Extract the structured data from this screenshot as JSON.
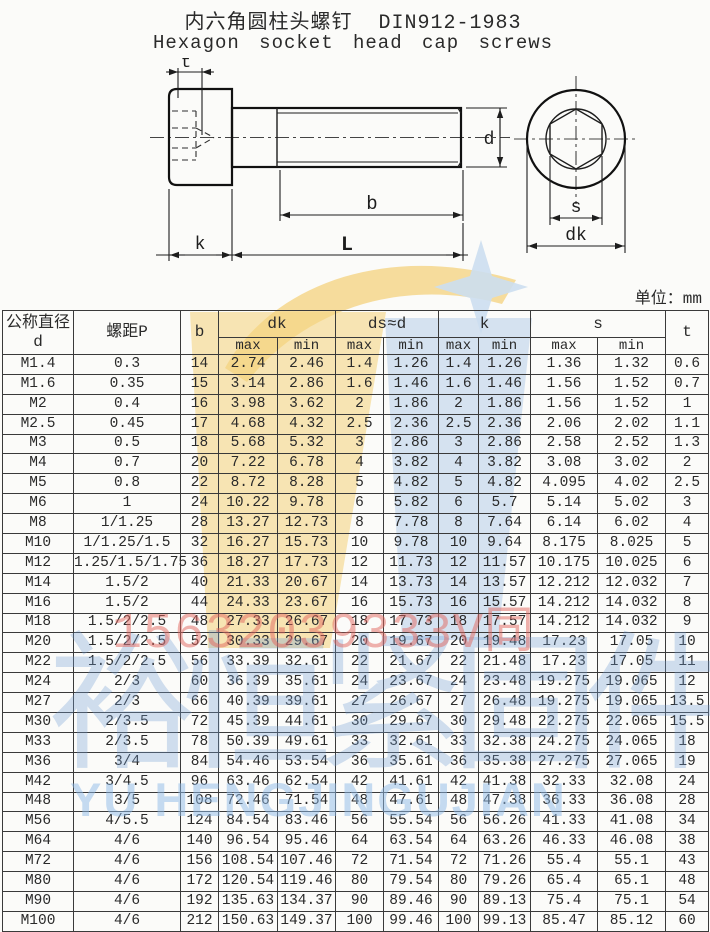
{
  "title": "内六角圆柱头螺钉  DIN912-1983",
  "subtitle": "Hexagon socket head cap screws",
  "unit_note": "单位：mm",
  "diagram": {
    "labels": {
      "t": "t",
      "d": "d",
      "b": "b",
      "k": "k",
      "L": "L",
      "s": "s",
      "dk": "dk"
    }
  },
  "watermark": {
    "phone": "15632039333V同",
    "company_cn": "裕恒紧固件",
    "company_en": "YU HENGJINGUJIAN",
    "yellow": "#f5d584",
    "blue": "#bcd2e9",
    "star_blue": "#ccdeef",
    "red": "#e2655d"
  },
  "table": {
    "headers": {
      "col1_line1": "公称直径",
      "col1_line2": "d",
      "pitch": "螺距P",
      "b": "b",
      "dk": "dk",
      "ds": "ds≈d",
      "k": "k",
      "s": "s",
      "t": "t",
      "max": "max",
      "min": "min"
    },
    "rows": [
      [
        "M1.4",
        "0.3",
        "14",
        "2.74",
        "2.46",
        "1.4",
        "1.26",
        "1.4",
        "1.26",
        "1.36",
        "1.32",
        "0.6"
      ],
      [
        "M1.6",
        "0.35",
        "15",
        "3.14",
        "2.86",
        "1.6",
        "1.46",
        "1.6",
        "1.46",
        "1.56",
        "1.52",
        "0.7"
      ],
      [
        "M2",
        "0.4",
        "16",
        "3.98",
        "3.62",
        "2",
        "1.86",
        "2",
        "1.86",
        "1.56",
        "1.52",
        "1"
      ],
      [
        "M2.5",
        "0.45",
        "17",
        "4.68",
        "4.32",
        "2.5",
        "2.36",
        "2.5",
        "2.36",
        "2.06",
        "2.02",
        "1.1"
      ],
      [
        "M3",
        "0.5",
        "18",
        "5.68",
        "5.32",
        "3",
        "2.86",
        "3",
        "2.86",
        "2.58",
        "2.52",
        "1.3"
      ],
      [
        "M4",
        "0.7",
        "20",
        "7.22",
        "6.78",
        "4",
        "3.82",
        "4",
        "3.82",
        "3.08",
        "3.02",
        "2"
      ],
      [
        "M5",
        "0.8",
        "22",
        "8.72",
        "8.28",
        "5",
        "4.82",
        "5",
        "4.82",
        "4.095",
        "4.02",
        "2.5"
      ],
      [
        "M6",
        "1",
        "24",
        "10.22",
        "9.78",
        "6",
        "5.82",
        "6",
        "5.7",
        "5.14",
        "5.02",
        "3"
      ],
      [
        "M8",
        "1/1.25",
        "28",
        "13.27",
        "12.73",
        "8",
        "7.78",
        "8",
        "7.64",
        "6.14",
        "6.02",
        "4"
      ],
      [
        "M10",
        "1/1.25/1.5",
        "32",
        "16.27",
        "15.73",
        "10",
        "9.78",
        "10",
        "9.64",
        "8.175",
        "8.025",
        "5"
      ],
      [
        "M12",
        "1.25/1.5/1.75",
        "36",
        "18.27",
        "17.73",
        "12",
        "11.73",
        "12",
        "11.57",
        "10.175",
        "10.025",
        "6"
      ],
      [
        "M14",
        "1.5/2",
        "40",
        "21.33",
        "20.67",
        "14",
        "13.73",
        "14",
        "13.57",
        "12.212",
        "12.032",
        "7"
      ],
      [
        "M16",
        "1.5/2",
        "44",
        "24.33",
        "23.67",
        "16",
        "15.73",
        "16",
        "15.57",
        "14.212",
        "14.032",
        "8"
      ],
      [
        "M18",
        "1.5/2/2.5",
        "48",
        "27.33",
        "26.67",
        "18",
        "17.73",
        "18",
        "17.57",
        "14.212",
        "14.032",
        "9"
      ],
      [
        "M20",
        "1.5/2/2.5",
        "52",
        "30.33",
        "29.67",
        "20",
        "19.67",
        "20",
        "19.48",
        "17.23",
        "17.05",
        "10"
      ],
      [
        "M22",
        "1.5/2/2.5",
        "56",
        "33.39",
        "32.61",
        "22",
        "21.67",
        "22",
        "21.48",
        "17.23",
        "17.05",
        "11"
      ],
      [
        "M24",
        "2/3",
        "60",
        "36.39",
        "35.61",
        "24",
        "23.67",
        "24",
        "23.48",
        "19.275",
        "19.065",
        "12"
      ],
      [
        "M27",
        "2/3",
        "66",
        "40.39",
        "39.61",
        "27",
        "26.67",
        "27",
        "26.48",
        "19.275",
        "19.065",
        "13.5"
      ],
      [
        "M30",
        "2/3.5",
        "72",
        "45.39",
        "44.61",
        "30",
        "29.67",
        "30",
        "29.48",
        "22.275",
        "22.065",
        "15.5"
      ],
      [
        "M33",
        "2/3.5",
        "78",
        "50.39",
        "49.61",
        "33",
        "32.61",
        "33",
        "32.38",
        "24.275",
        "24.065",
        "18"
      ],
      [
        "M36",
        "3/4",
        "84",
        "54.46",
        "53.54",
        "36",
        "35.61",
        "36",
        "35.38",
        "27.275",
        "27.065",
        "19"
      ],
      [
        "M42",
        "3/4.5",
        "96",
        "63.46",
        "62.54",
        "42",
        "41.61",
        "42",
        "41.38",
        "32.33",
        "32.08",
        "24"
      ],
      [
        "M48",
        "3/5",
        "108",
        "72.46",
        "71.54",
        "48",
        "47.61",
        "48",
        "47.38",
        "36.33",
        "36.08",
        "28"
      ],
      [
        "M56",
        "4/5.5",
        "124",
        "84.54",
        "83.46",
        "56",
        "55.54",
        "56",
        "56.26",
        "41.33",
        "41.08",
        "34"
      ],
      [
        "M64",
        "4/6",
        "140",
        "96.54",
        "95.46",
        "64",
        "63.54",
        "64",
        "63.26",
        "46.33",
        "46.08",
        "38"
      ],
      [
        "M72",
        "4/6",
        "156",
        "108.54",
        "107.46",
        "72",
        "71.54",
        "72",
        "71.26",
        "55.4",
        "55.1",
        "43"
      ],
      [
        "M80",
        "4/6",
        "172",
        "120.54",
        "119.46",
        "80",
        "79.54",
        "80",
        "79.26",
        "65.4",
        "65.1",
        "48"
      ],
      [
        "M90",
        "4/6",
        "192",
        "135.63",
        "134.37",
        "90",
        "89.46",
        "90",
        "89.13",
        "75.4",
        "75.1",
        "54"
      ],
      [
        "M100",
        "4/6",
        "212",
        "150.63",
        "149.37",
        "100",
        "99.46",
        "100",
        "99.13",
        "85.47",
        "85.12",
        "60"
      ]
    ]
  }
}
